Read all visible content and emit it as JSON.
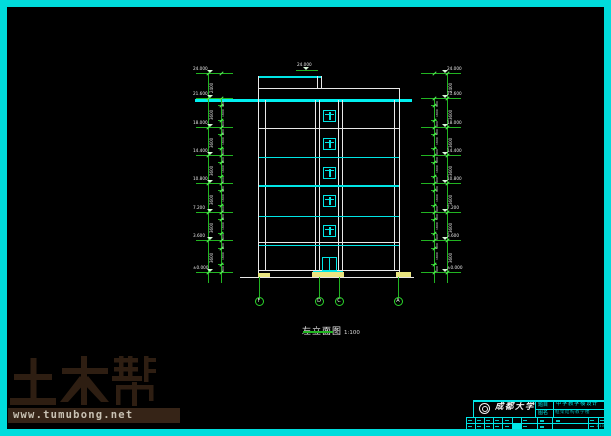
{
  "colors": {
    "cyan": "#00e6e6",
    "green": "#21b421",
    "bright_green": "#57e857",
    "white": "#e8e8e8",
    "yellow": "#eae580",
    "border": "#00dcdc",
    "watermark_brown": "#2e1e12",
    "watermark_bar": "#362417"
  },
  "drawing": {
    "title": "左立面图",
    "scale": "1:100",
    "roof_marker_label": "24.000",
    "levels": [
      {
        "y": 73,
        "label": "24.000"
      },
      {
        "y": 98,
        "label": "21.600"
      },
      {
        "y": 127,
        "label": "18.000"
      },
      {
        "y": 155,
        "label": "14.400"
      },
      {
        "y": 183,
        "label": "10.800"
      },
      {
        "y": 212,
        "label": "7.200"
      },
      {
        "y": 240,
        "label": "3.600"
      },
      {
        "y": 272,
        "label": "±0.000"
      }
    ],
    "story_dims": [
      "2400",
      "3600",
      "3600",
      "3600",
      "3600",
      "3600",
      "3600"
    ],
    "sub_dims": [
      "900",
      "1800",
      "900"
    ],
    "axes": [
      {
        "x": 259,
        "label": "F"
      },
      {
        "x": 319,
        "label": "D"
      },
      {
        "x": 339,
        "label": "C"
      },
      {
        "x": 398,
        "label": "A"
      }
    ],
    "floor_lines": [
      {
        "y": 128,
        "color": "white",
        "thick": false
      },
      {
        "y": 157,
        "color": "cyan",
        "thick": false
      },
      {
        "y": 185,
        "color": "cyan",
        "thick": true
      },
      {
        "y": 216,
        "color": "cyan",
        "thick": false
      },
      {
        "y": 242,
        "color": "white",
        "thick": false
      },
      {
        "y": 244.5,
        "color": "cyan",
        "thick": false
      },
      {
        "y": 270,
        "color": "white",
        "thick": false
      }
    ],
    "windows": [
      {
        "y": 110,
        "h": 12
      },
      {
        "y": 138,
        "h": 12
      },
      {
        "y": 166.5,
        "h": 12
      },
      {
        "y": 195,
        "h": 12
      },
      {
        "y": 225,
        "h": 12
      }
    ],
    "door": {
      "y": 256.5,
      "h": 14.5
    }
  },
  "watermark": {
    "brand": "土木帮",
    "url": "www.tumubong.net"
  },
  "titleblock": {
    "school": "成都大学",
    "field1_label": "题目",
    "field1_value": "中学教学楼设计",
    "field2_label": "图名",
    "field2_value": "框架结构教学楼",
    "scale_value": "1:100"
  }
}
